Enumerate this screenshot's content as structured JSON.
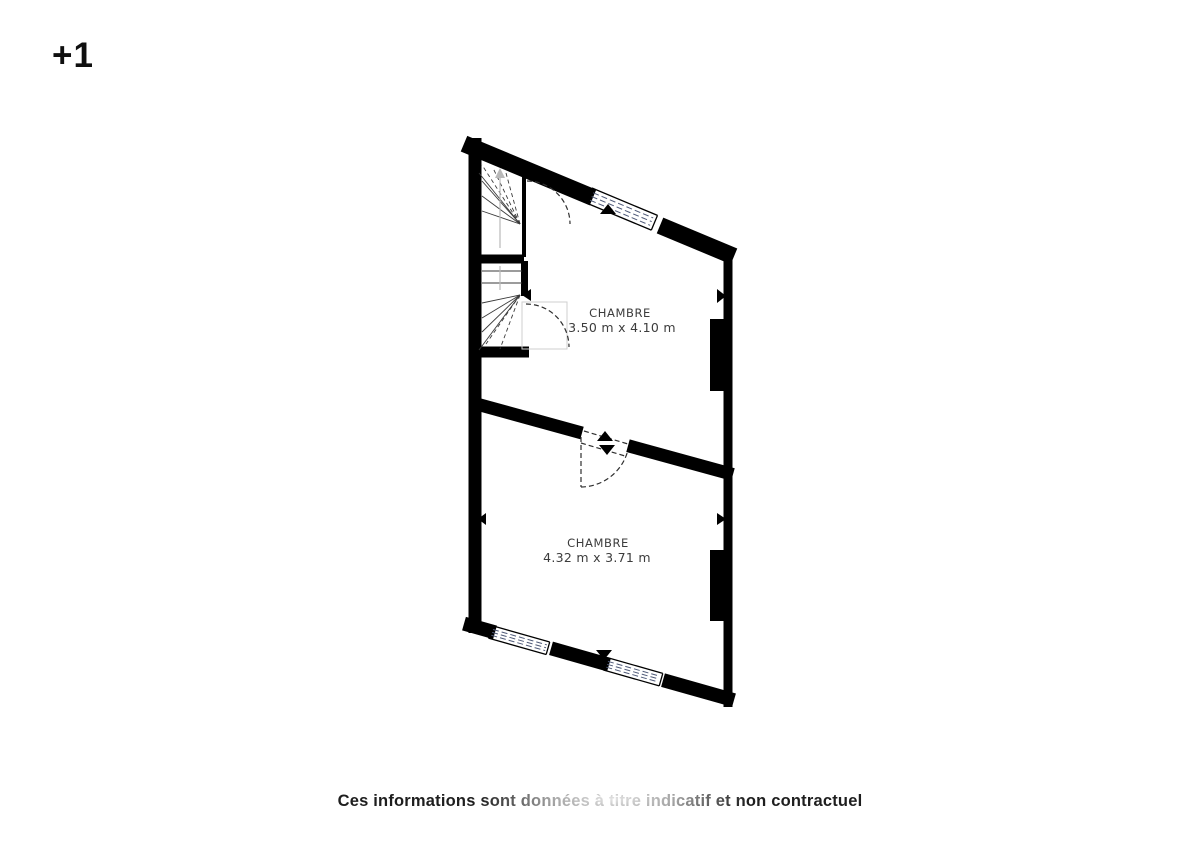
{
  "floor": {
    "label": "+1"
  },
  "plan": {
    "rooms": [
      {
        "name": "CHAMBRE",
        "dimensions": "3.50 m x 4.10 m"
      },
      {
        "name": "CHAMBRE",
        "dimensions": "4.32 m x 3.71 m"
      }
    ]
  },
  "footer": {
    "disclaimer": "Ces informations sont données à titre indicatif et non contractuel"
  },
  "colors": {
    "wall": "#000000",
    "room_label": "#3c3c3c",
    "window_dash": "#4f5a78",
    "disclaimer_text": "#1e1e1e",
    "background": "#ffffff"
  }
}
